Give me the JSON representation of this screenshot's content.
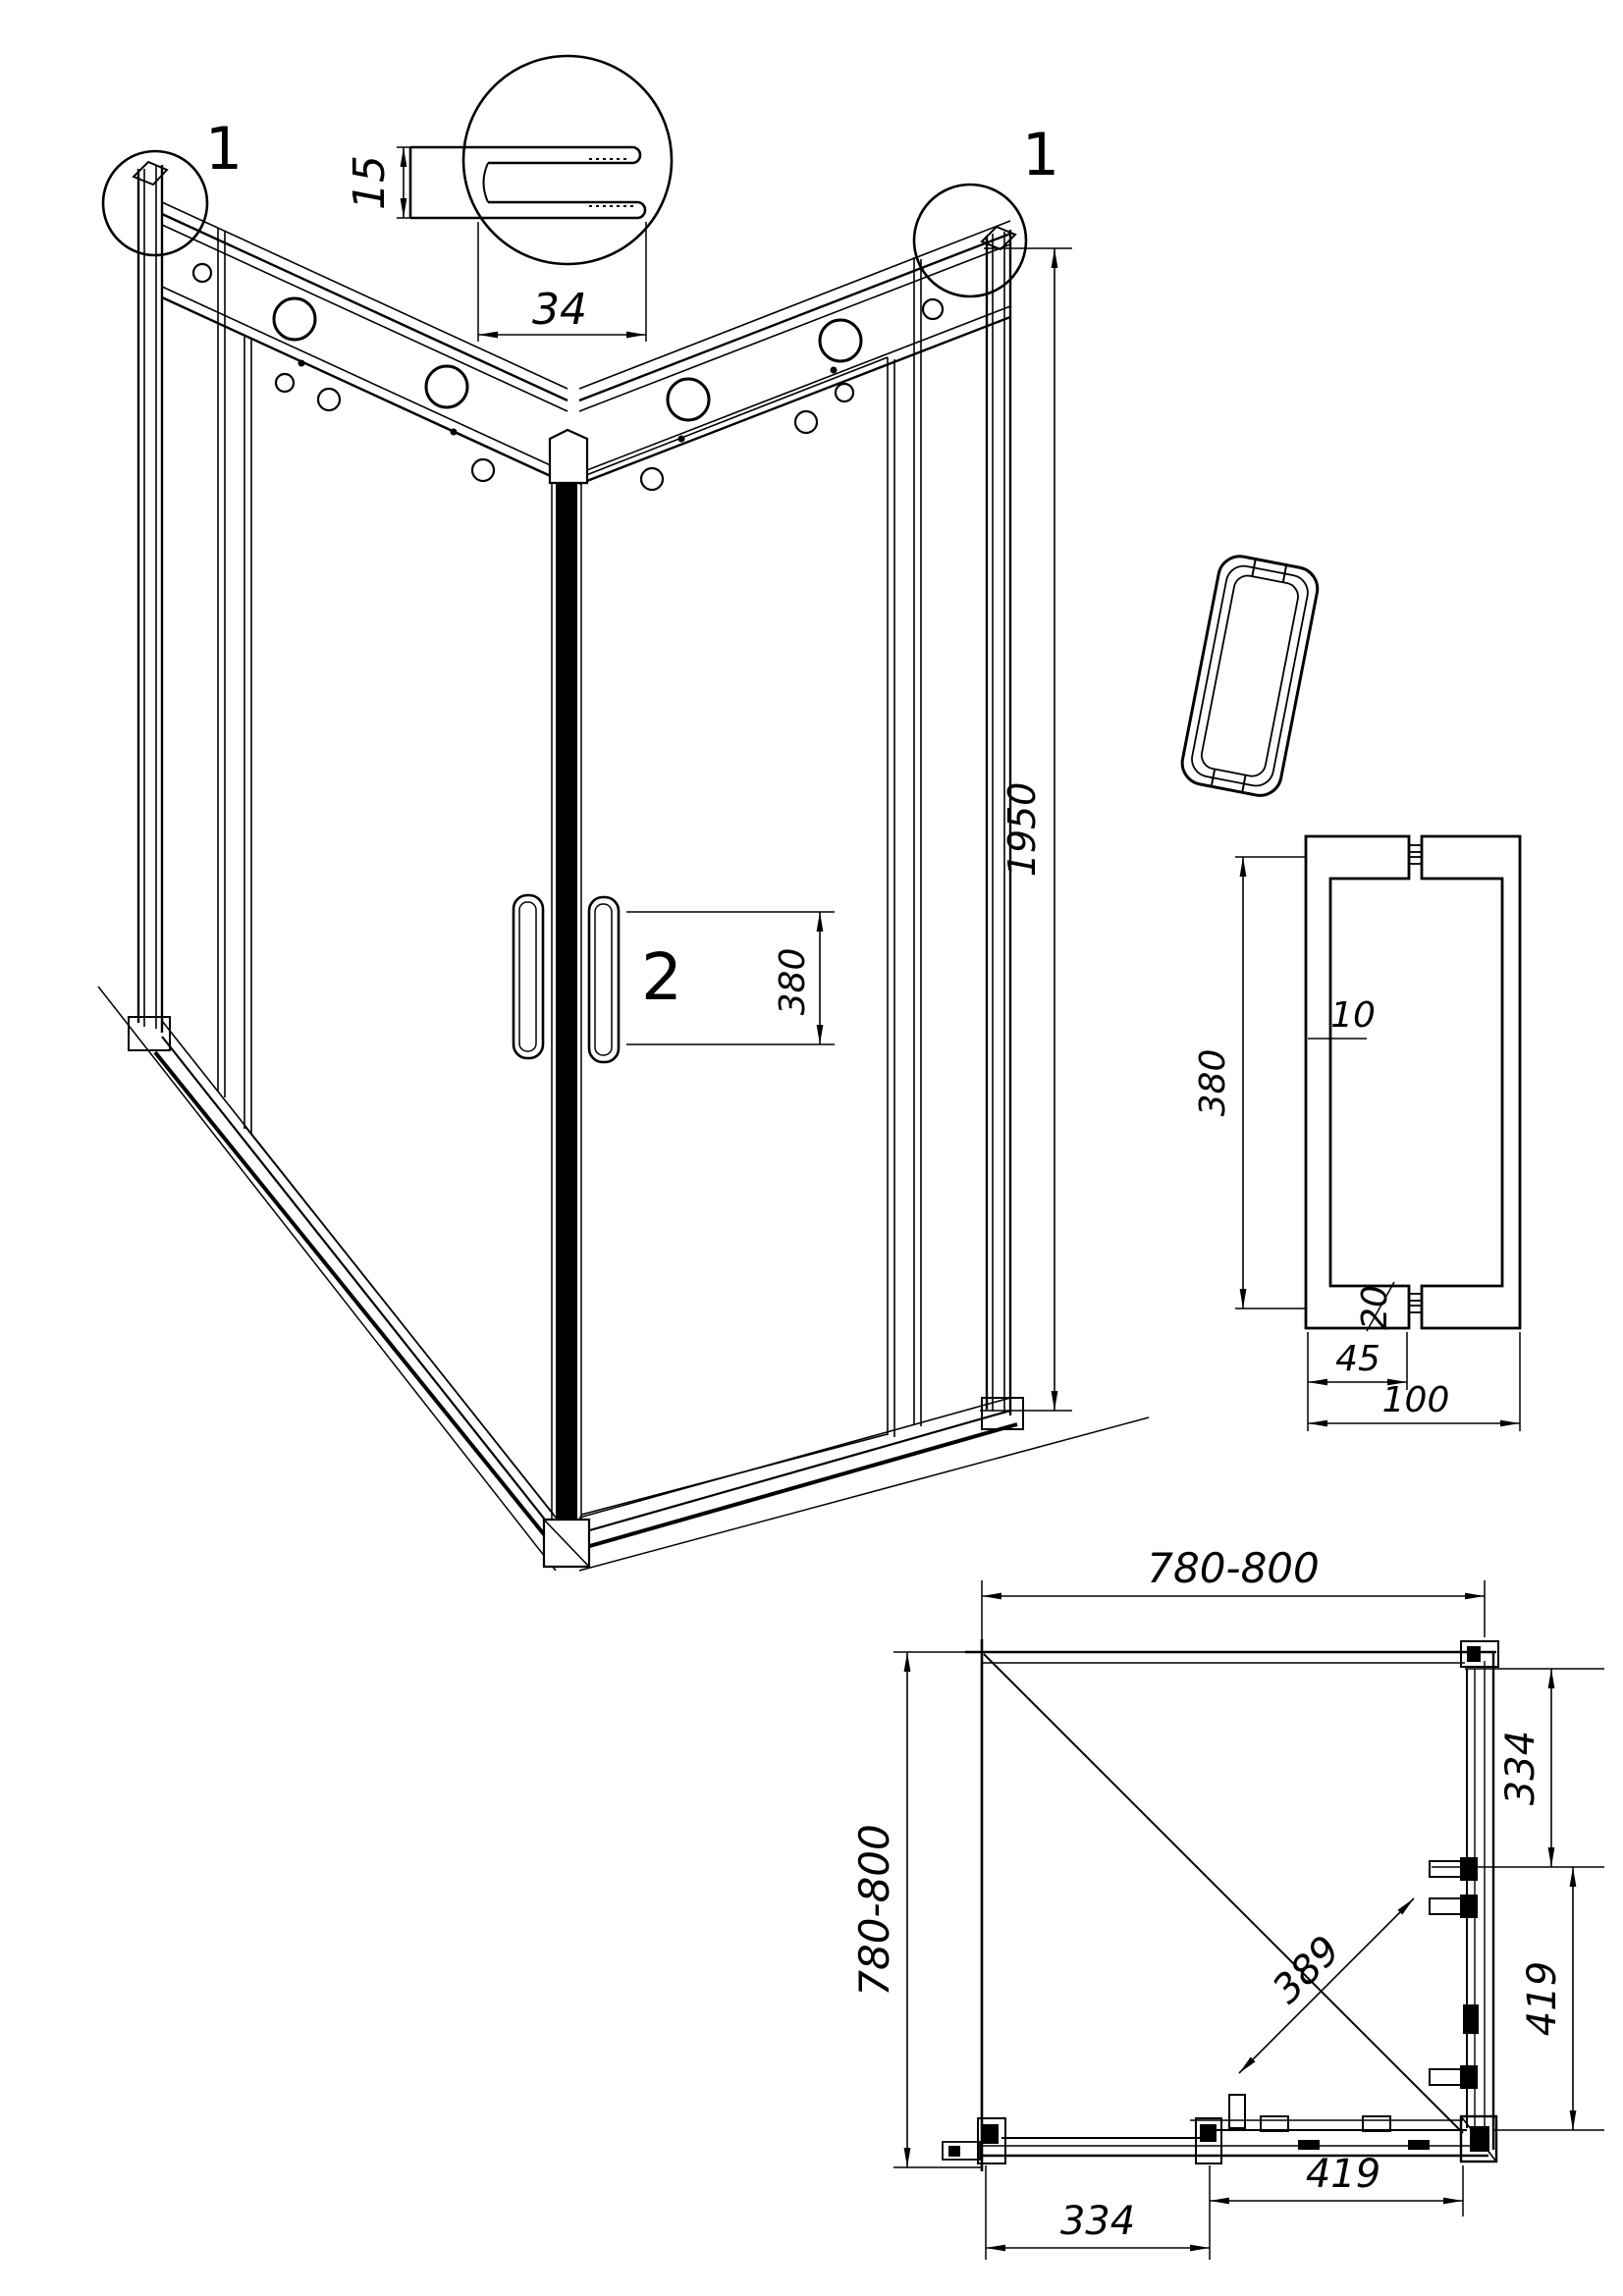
{
  "page": {
    "background": "#ffffff",
    "line_color": "#000000"
  },
  "main_view": {
    "detail_marker_left": "1",
    "detail_marker_right": "1",
    "handle_marker": "2",
    "handle_spacing_dim": "380",
    "overall_height_dim": "1950"
  },
  "profile_detail": {
    "height_dim": "15",
    "depth_dim": "34"
  },
  "handle_detail": {
    "length_dim": "380",
    "bar_thickness_dim": "10",
    "boss_dim": "20",
    "boss_width_dim": "45",
    "overall_width_dim": "100"
  },
  "plan_view": {
    "width_dim": "780-800",
    "depth_dim": "780-800",
    "right_fixed_dim": "334",
    "right_door_dim": "419",
    "diagonal_dim": "389",
    "bottom_fixed_dim": "334",
    "bottom_door_dim": "419"
  }
}
